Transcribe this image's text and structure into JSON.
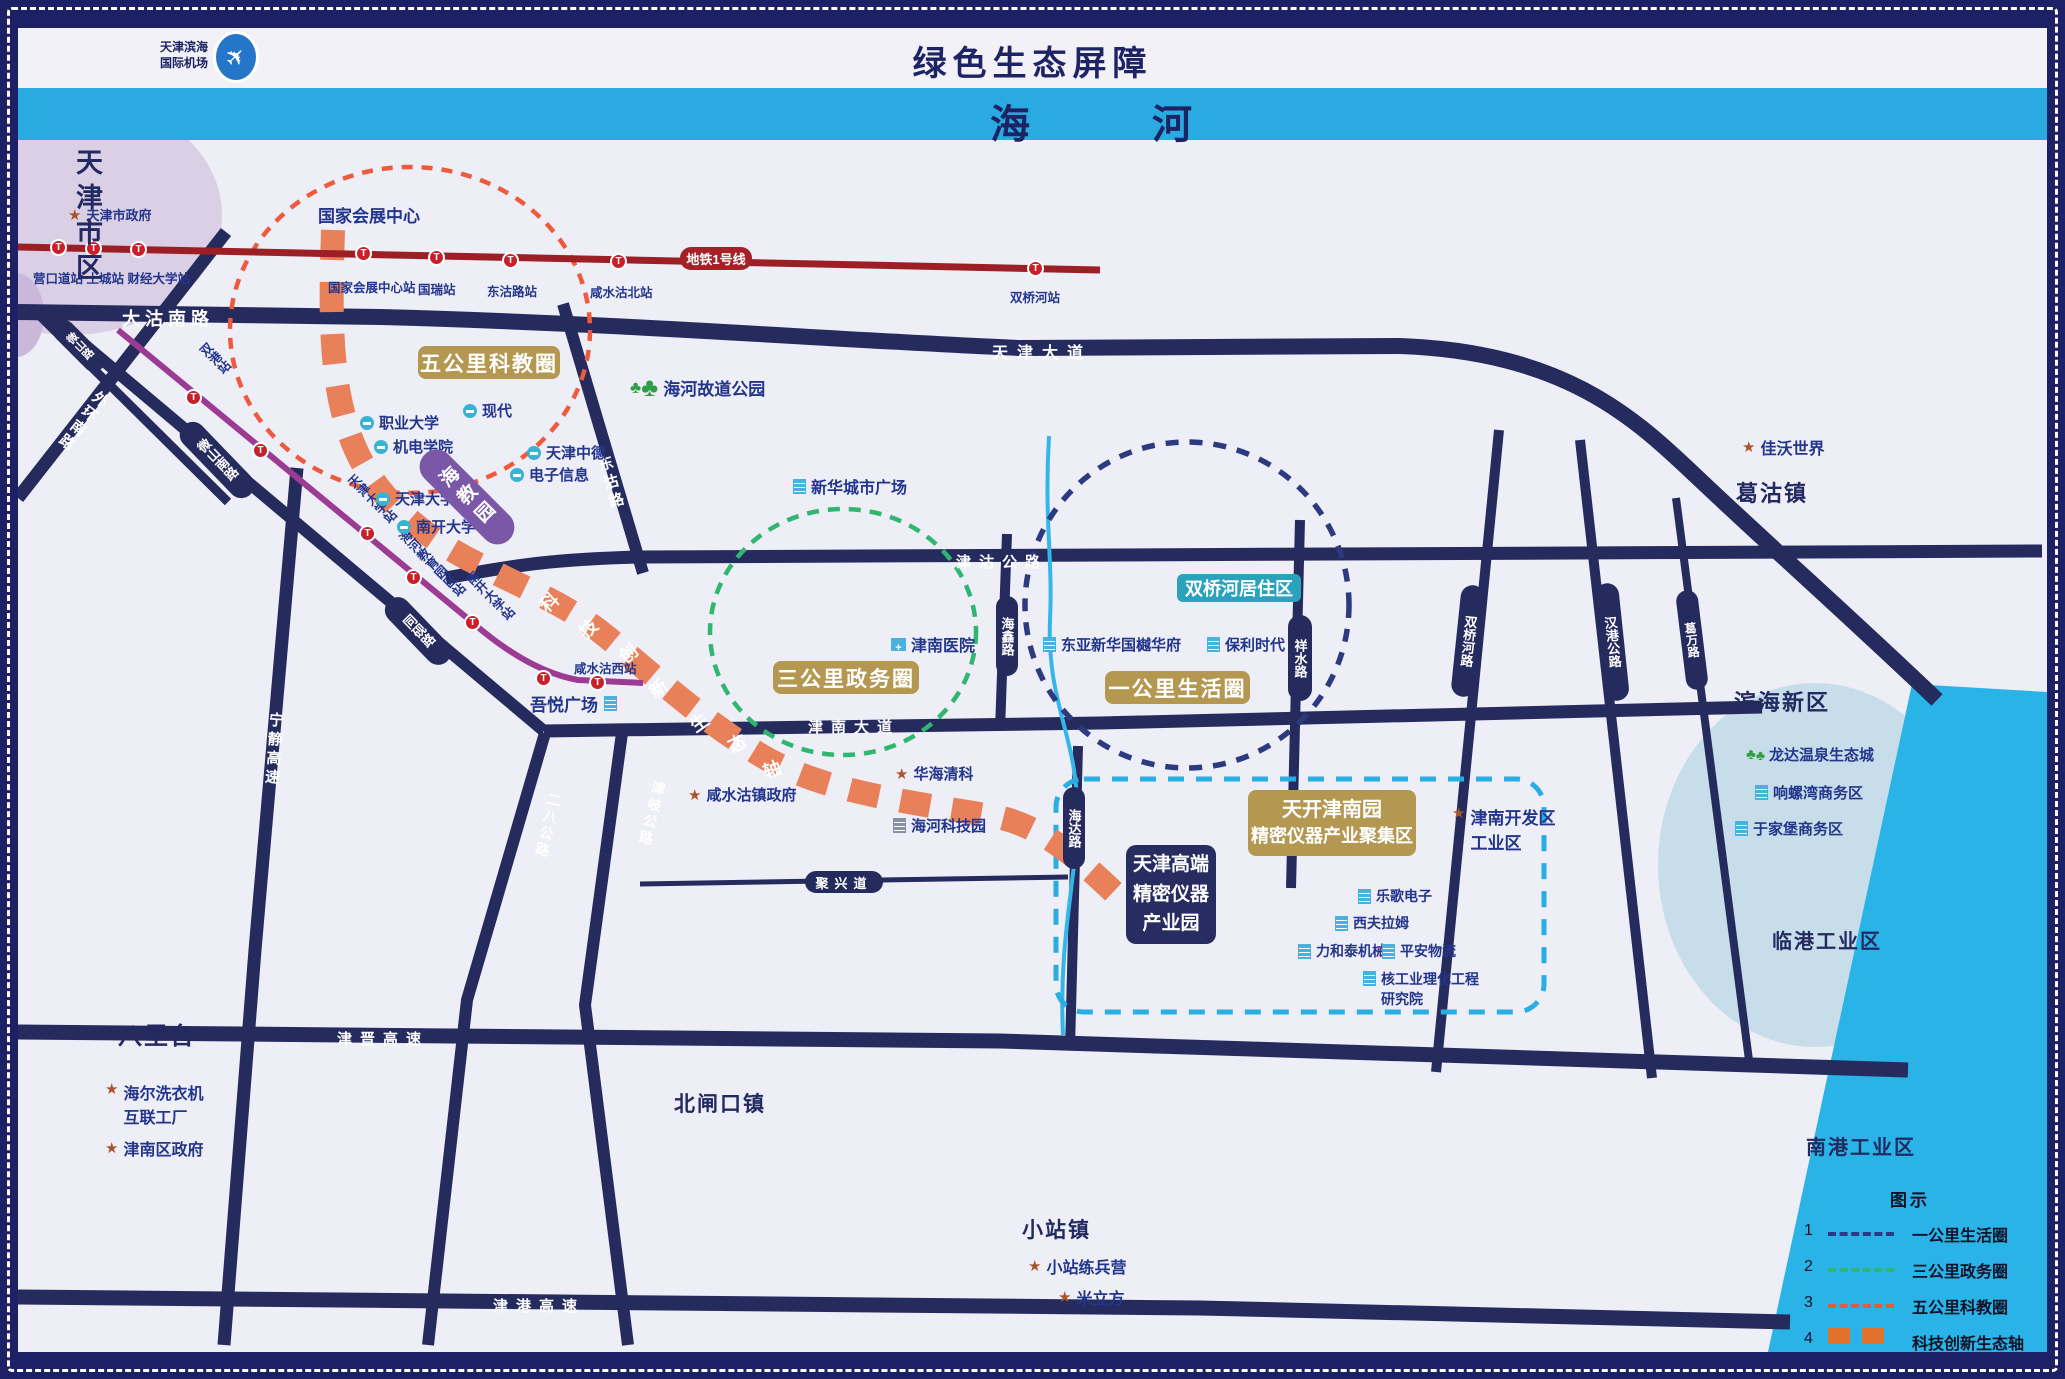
{
  "colors": {
    "sea": "#29b3e6",
    "axis_orange": "#e88059",
    "circle_1km": "#2e3a80",
    "circle_3km": "#2fb66f",
    "circle_5km": "#ee5a3d",
    "metro_line1": "#9b1f24",
    "metro_purple": "#9b3b94",
    "road": "#262b5d",
    "tan": "#b49852",
    "teal": "#2aa2bc",
    "banner_blue": "#29abe2"
  },
  "header": {
    "airport_l1": "天津滨海",
    "airport_l2": "国际机场",
    "title": "绿色生态屏障",
    "banner_l": "海",
    "banner_r": "河"
  },
  "metro1": {
    "badge": "地铁1号线",
    "west": "营口道站 土城站 财经大学站",
    "s_huizhan": "国家会展中心站",
    "s_guorui": "国瑞站",
    "s_donggu": "东沽路站",
    "s_xianshuigu": "咸水沽北站",
    "s_shuangqiaohe": "双桥河站"
  },
  "metro2": {
    "s_shuanggang": "双港站",
    "s_tju": "天津大学站",
    "s_haihe": "海河教育园区站",
    "s_nku": "南开大学站",
    "s_xsgx": "咸水沽西站"
  },
  "roads": {
    "dagunan": "大沽南路",
    "tianjindadao": "天津大道",
    "jingu": "津沽公路",
    "jinnandadao": "津南大道",
    "juxing": "聚兴道",
    "jinjin": "津晋高速",
    "jingang": "津港高速",
    "waihuan": "外环南路",
    "weishan": "微山路",
    "weishannan": "微山南路",
    "tongyan": "同砚路",
    "ningjing": "宁静高速",
    "erba": "二八公路",
    "jinqi": "津岐公路",
    "donggu": "东沽路",
    "haixin": "海鑫路",
    "xiangshui": "祥水路",
    "haida": "海达路",
    "shuangqiaohe": "双桥河路",
    "hangang": "汉港公路",
    "gewan": "葛万路"
  },
  "zones": {
    "wugongli": "五公里科教圈",
    "sangongli": "三公里政务圈",
    "yigongli": "一公里生活圈",
    "sqh_res": "双桥河居住区",
    "haijiaoyuan": "海教园",
    "tiankai_l1": "天开津南园",
    "tiankai_l2": "精密仪器产业聚集区",
    "gaoduan_l1": "天津高端",
    "gaoduan_l2": "精密仪器",
    "gaoduan_l3": "产业园"
  },
  "axis": {
    "chars": [
      "科",
      "技",
      "创",
      "新",
      "生",
      "态",
      "轴"
    ]
  },
  "places": {
    "tj_gov": "天津市政府",
    "convention": "国家会展中心",
    "haihe_park": "海河故道公园",
    "xinhua": "新华城市广场",
    "zhiye": "职业大学",
    "jidian": "机电学院",
    "xiandai": "现代",
    "zhongde": "天津中德",
    "dianzi": "电子信息",
    "tju": "天津大学",
    "nku": "南开大学",
    "jn_hospital": "津南医院",
    "dongya": "东亚新华国樾华府",
    "baoli": "保利时代",
    "wuyue": "吾悦广场",
    "xsg_gov": "咸水沽镇政府",
    "huahai": "华海清科",
    "keji_park": "海河科技园",
    "jiawo": "佳沃世界",
    "longda": "龙达温泉生态城",
    "xiangluo": "响螺湾商务区",
    "yujiapu": "于家堡商务区",
    "kaifa_l1": "津南开发区",
    "kaifa_l2": "工业区",
    "lege": "乐歌电子",
    "xifu": "西夫拉姆",
    "lihetai": "力和泰机械",
    "pingan": "平安物流",
    "hegong_l1": "核工业理化工程",
    "hegong_l2": "研究院",
    "haier_l1": "海尔洗衣机",
    "haier_l2": "互联工厂",
    "jn_gov": "津南区政府",
    "xiaozhan_camp": "小站练兵营",
    "milifang": "米立方"
  },
  "districts": {
    "shiqu": "天津市区",
    "bali": "八里台",
    "beizha": "北闸口镇",
    "xiaozhan": "小站镇",
    "gegu": "葛沽镇",
    "binhai": "滨海新区",
    "lingang": "临港工业区",
    "nangang": "南港工业区"
  },
  "legend": {
    "title": "图示",
    "items": [
      {
        "num": "1",
        "label": "一公里生活圈"
      },
      {
        "num": "2",
        "label": "三公里政务圈"
      },
      {
        "num": "3",
        "label": "五公里科教圈"
      },
      {
        "num": "4",
        "label": "科技创新生态轴"
      }
    ]
  }
}
